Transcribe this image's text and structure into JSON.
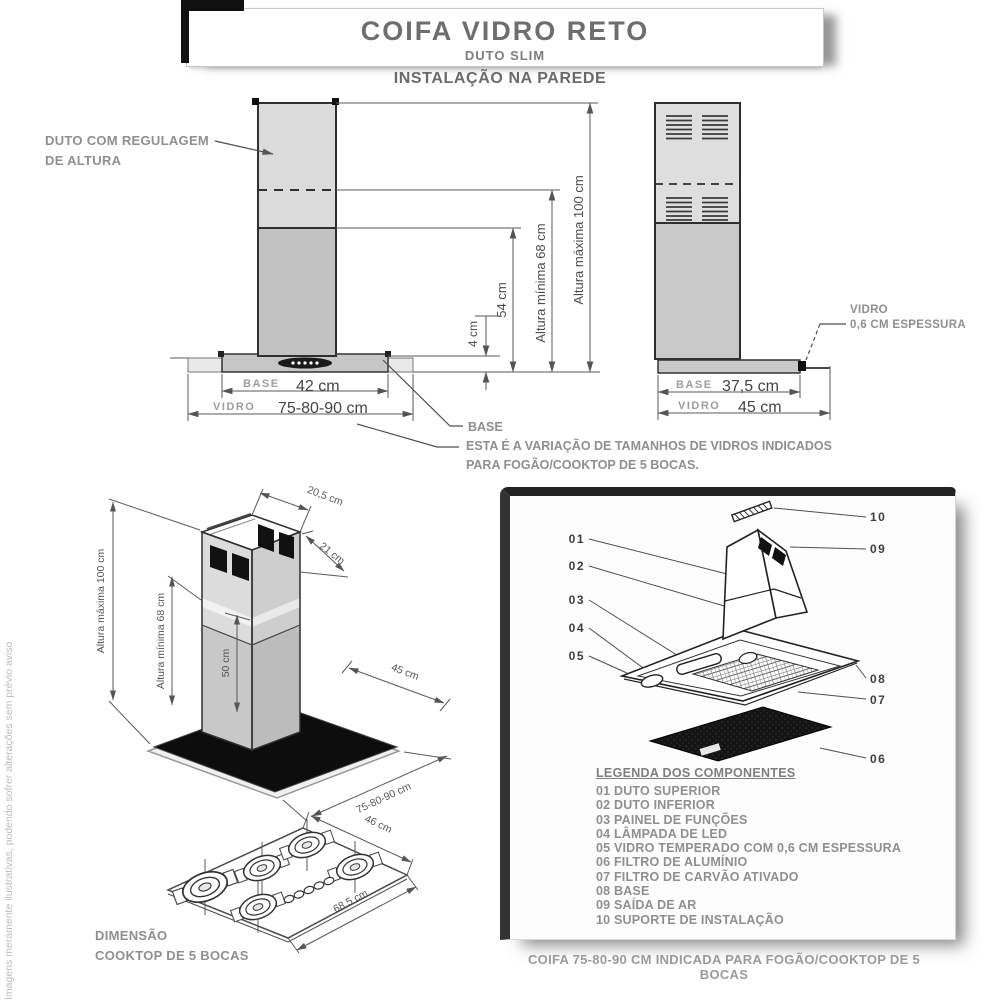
{
  "title": {
    "main": "COIFA VIDRO RETO",
    "subtitle": "DUTO SLIM"
  },
  "section_heading": "INSTALAÇÃO NA PAREDE",
  "front_view": {
    "duct_label_line1": "DUTO COM REGULAGEM",
    "duct_label_line2": "DE ALTURA",
    "dim_4": "4 cm",
    "dim_54": "54 cm",
    "dim_min": "Altura mínima 68 cm",
    "dim_max": "Altura máxima 100 cm",
    "base_word": "BASE",
    "base_value": "42 cm",
    "vidro_word": "VIDRO",
    "vidro_value": "75-80-90 cm",
    "base_callout": "BASE",
    "note_line1": "ESTA É A VARIAÇÃO DE TAMANHOS DE VIDROS INDICADOS",
    "note_line2": "PARA FOGÃO/COOKTOP DE 5 BOCAS."
  },
  "side_view": {
    "vidro_callout_line1": "VIDRO",
    "vidro_callout_line2": "0,6 CM ESPESSURA",
    "base_word": "BASE",
    "base_value": "37,5 cm",
    "vidro_word": "VIDRO",
    "vidro_value": "45 cm"
  },
  "iso_view": {
    "dim_max": "Altura máxima 100 cm",
    "dim_min": "Altura mínima 68 cm",
    "dim_50": "50 cm",
    "dim_205": "20,5 cm",
    "dim_21": "21 cm",
    "dim_45": "45 cm",
    "dim_width": "75-80-90 cm"
  },
  "cooktop": {
    "dim_depth": "46 cm",
    "dim_width": "68,5 cm",
    "label_line1": "DIMENSÃO",
    "label_line2": "COOKTOP  DE 5 BOCAS"
  },
  "components_panel": {
    "callouts": [
      "01",
      "02",
      "03",
      "04",
      "05",
      "06",
      "07",
      "08",
      "09",
      "10"
    ],
    "legend_title": "LEGENDA DOS COMPONENTES",
    "legend_items": [
      "01 DUTO SUPERIOR",
      "02 DUTO INFERIOR",
      "03 PAINEL DE FUNÇÕES",
      "04 LÂMPADA DE LED",
      "05 VIDRO TEMPERADO COM 0,6 CM ESPESSURA",
      "06 FILTRO DE ALUMÍNIO",
      "07 FILTRO DE CARVÃO ATIVADO",
      "08 BASE",
      "09 SAÍDA DE AR",
      "10 SUPORTE DE INSTALAÇÃO"
    ]
  },
  "caption": "COIFA 75-80-90 CM INDICADA PARA FOGÃO/COOKTOP DE 5 BOCAS",
  "watermark": "Imagens meramente ilustrativas, podendo sofrer alterações sem prévio aviso",
  "colors": {
    "duct_upper_fill": "#dbdbdb",
    "duct_lower_fill": "#c2c2c2",
    "outline": "#2f2f2f",
    "dim_line": "#5a5a5a",
    "label_gray": "#8f8f8f",
    "glass_black": "#0d0d0d"
  }
}
